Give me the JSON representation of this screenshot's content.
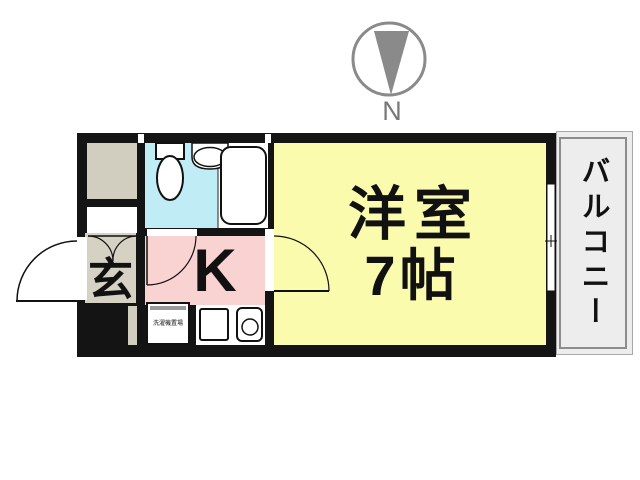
{
  "compass": {
    "label": "N"
  },
  "rooms": {
    "main_room": {
      "name": "洋室",
      "size": "7帖"
    },
    "kitchen": {
      "label": "K"
    },
    "entrance": {
      "label": "玄"
    },
    "balcony": {
      "label": "バルコニー"
    },
    "laundry": {
      "label": "洗濯機置場"
    }
  },
  "colors": {
    "wall": "#141414",
    "main_room": "#FBFBAE",
    "kitchen": "#F9D2D2",
    "bathroom": "#C0EDF5",
    "closet": "#D1CDBF",
    "entrance": "#D5D1C3",
    "balcony": "#EDEDED",
    "compass": "#8A8A8A"
  }
}
